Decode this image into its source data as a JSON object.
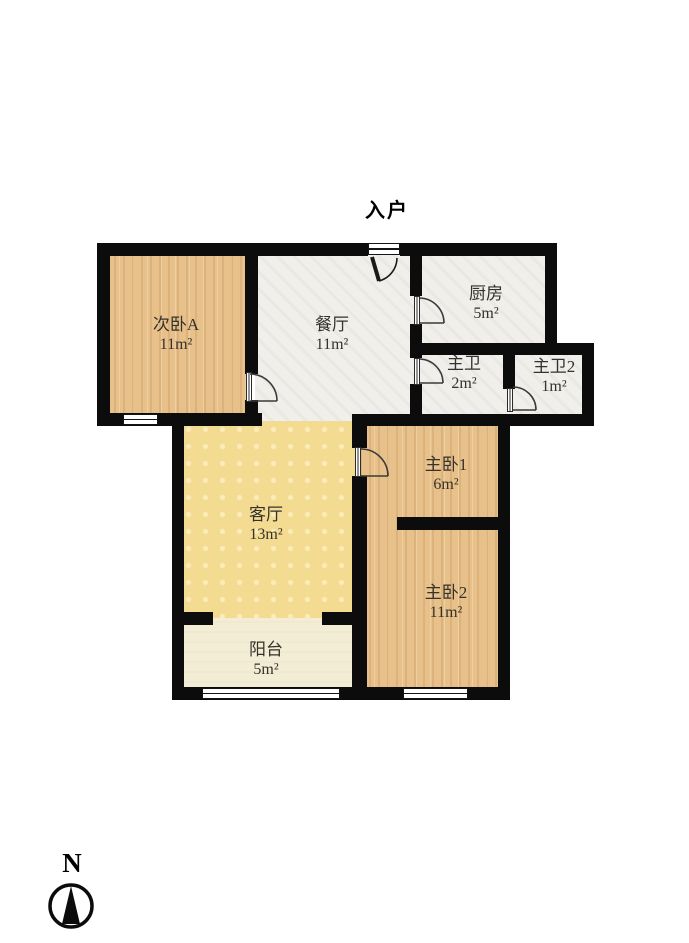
{
  "plan": {
    "entrance_label": "入户",
    "compass_letter": "N"
  },
  "rooms": [
    {
      "id": "bedroom-a",
      "name": "次卧A",
      "area": "11m²"
    },
    {
      "id": "dining-room",
      "name": "餐厅",
      "area": "11m²"
    },
    {
      "id": "kitchen",
      "name": "厨房",
      "area": "5m²"
    },
    {
      "id": "master-bath",
      "name": "主卫",
      "area": "2m²"
    },
    {
      "id": "master-bath-2",
      "name": "主卫2",
      "area": "1m²"
    },
    {
      "id": "living-room",
      "name": "客厅",
      "area": "13m²"
    },
    {
      "id": "master-bedroom-1",
      "name": "主卧1",
      "area": "6m²"
    },
    {
      "id": "master-bedroom-2",
      "name": "主卧2",
      "area": "11m²"
    },
    {
      "id": "balcony",
      "name": "阳台",
      "area": "5m²"
    }
  ],
  "colors": {
    "wall": "#0c0c0c",
    "wood_floor": "#e7c08a",
    "tile_floor": "#f0efeb",
    "living_floor": "#f4db92",
    "balcony_floor": "#f4edd6",
    "label_text": "#35322c",
    "background": "#ffffff"
  }
}
